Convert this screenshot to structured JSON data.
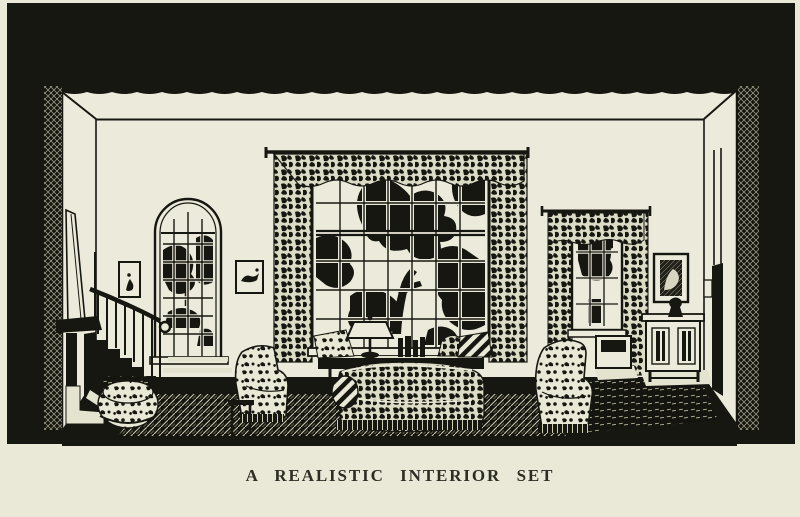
{
  "page": {
    "caption": "A REALISTIC INTERIOR SET",
    "paper_color": "#eae9d8",
    "ink_color": "#171711"
  },
  "illustration": {
    "alt": "Black-and-white engraved illustration of a realistic box-set stage interior: a living room with a staircase at left, an arched window, a large curtained picture window at center with tree silhouettes beyond, a smaller curtained window, cabinet with vase and framed pictures at right, a patterned sofa, wing chairs and ottoman on a dark hatched floor, all framed by black stage masking",
    "elements": [
      "stage-masking",
      "ceiling",
      "back-wall",
      "left-wall",
      "right-wall",
      "staircase",
      "stair-rail",
      "arched-window",
      "framed-picture-left",
      "framed-picture-center",
      "main-window",
      "curtains",
      "valance",
      "console-table",
      "table-lamp",
      "books",
      "sofa",
      "bolster-pillow",
      "striped-pillow",
      "wing-chair-left",
      "wing-chair-right",
      "ottoman",
      "side-table",
      "right-window",
      "radiator",
      "cabinet",
      "vase",
      "framed-picture-right",
      "switch-plate",
      "floor-rug",
      "stage-floor"
    ]
  }
}
